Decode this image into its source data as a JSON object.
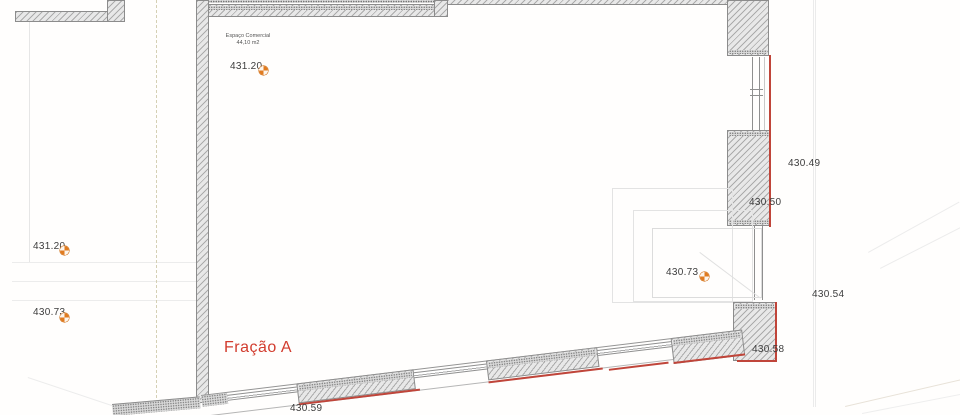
{
  "drawing": {
    "unit_label": {
      "name": "Espaço Comercial",
      "area": "44,10 m2"
    },
    "fraction_label": "Fração A",
    "levels": {
      "top_interior": "431.20",
      "left_upper": "431.20",
      "left_lower": "430.73",
      "right_interior": "430.73",
      "right_upper": "430.49",
      "right_mid": "430.50",
      "right_outer": "430.54",
      "right_lower": "430.58",
      "bottom": "430.59"
    },
    "icons": {
      "level_marker": "benchmark-quadrant-circle"
    },
    "colors": {
      "boundary_red": "#c0453a",
      "fraction_red": "#d23c2e",
      "marker_orange": "#e07b20",
      "wall_hatch_gray": "#ababab"
    }
  }
}
